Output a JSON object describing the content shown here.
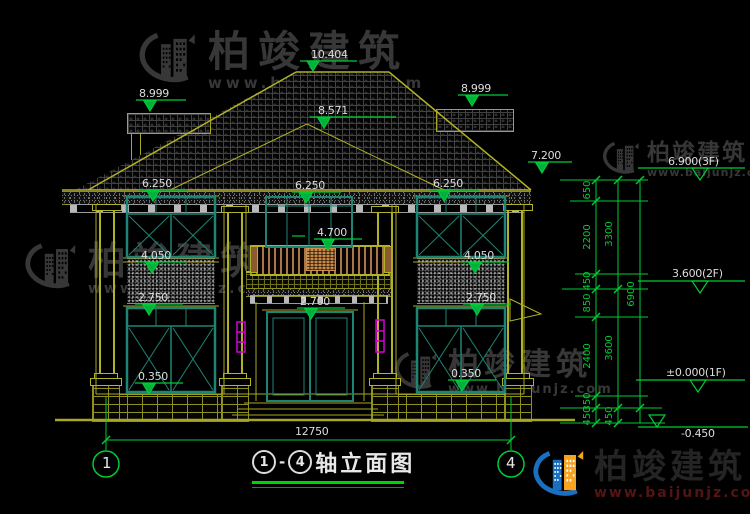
{
  "watermark": {
    "company": "柏竣建筑",
    "url": "www.baijunjz.com"
  },
  "title": {
    "start": "1",
    "separator": "-",
    "end": "4",
    "name": "轴立面图"
  },
  "axes": {
    "left": "1",
    "right": "4"
  },
  "levels": {
    "ridge": "10.404",
    "side_parapet": "8.999",
    "mid_ridge": "8.571",
    "eave": "7.200",
    "floor3": "6.900(3F)",
    "window_head_2f": "6.250",
    "balcony": "4.700",
    "window_sill_2f": "4.050",
    "floor2": "3.600(2F)",
    "window_head_1f": "2.750",
    "door_head": "2.700",
    "window_sill_1f": "0.350",
    "floor1": "±0.000(1F)",
    "ground": "-0.450"
  },
  "dimensions": {
    "total_width": "12750",
    "chain_a": [
      "650",
      "2200",
      "450",
      "850",
      "2400",
      "350",
      "450"
    ],
    "chain_b": [
      "3300",
      "3600",
      "450"
    ],
    "chain_c": [
      "6900"
    ]
  },
  "colors": {
    "background": "#000000",
    "wall_line_olive": "#a8a81f",
    "dimension_green": "#00cc33",
    "window_teal": "#1e8474",
    "accent_magenta": "#d400d4",
    "railing_brown": "#a6774b",
    "text_white": "#dcdcdc",
    "watermark_gray": "#373737",
    "logo_blue": "#1a6fc0",
    "logo_orange": "#f5a321"
  }
}
